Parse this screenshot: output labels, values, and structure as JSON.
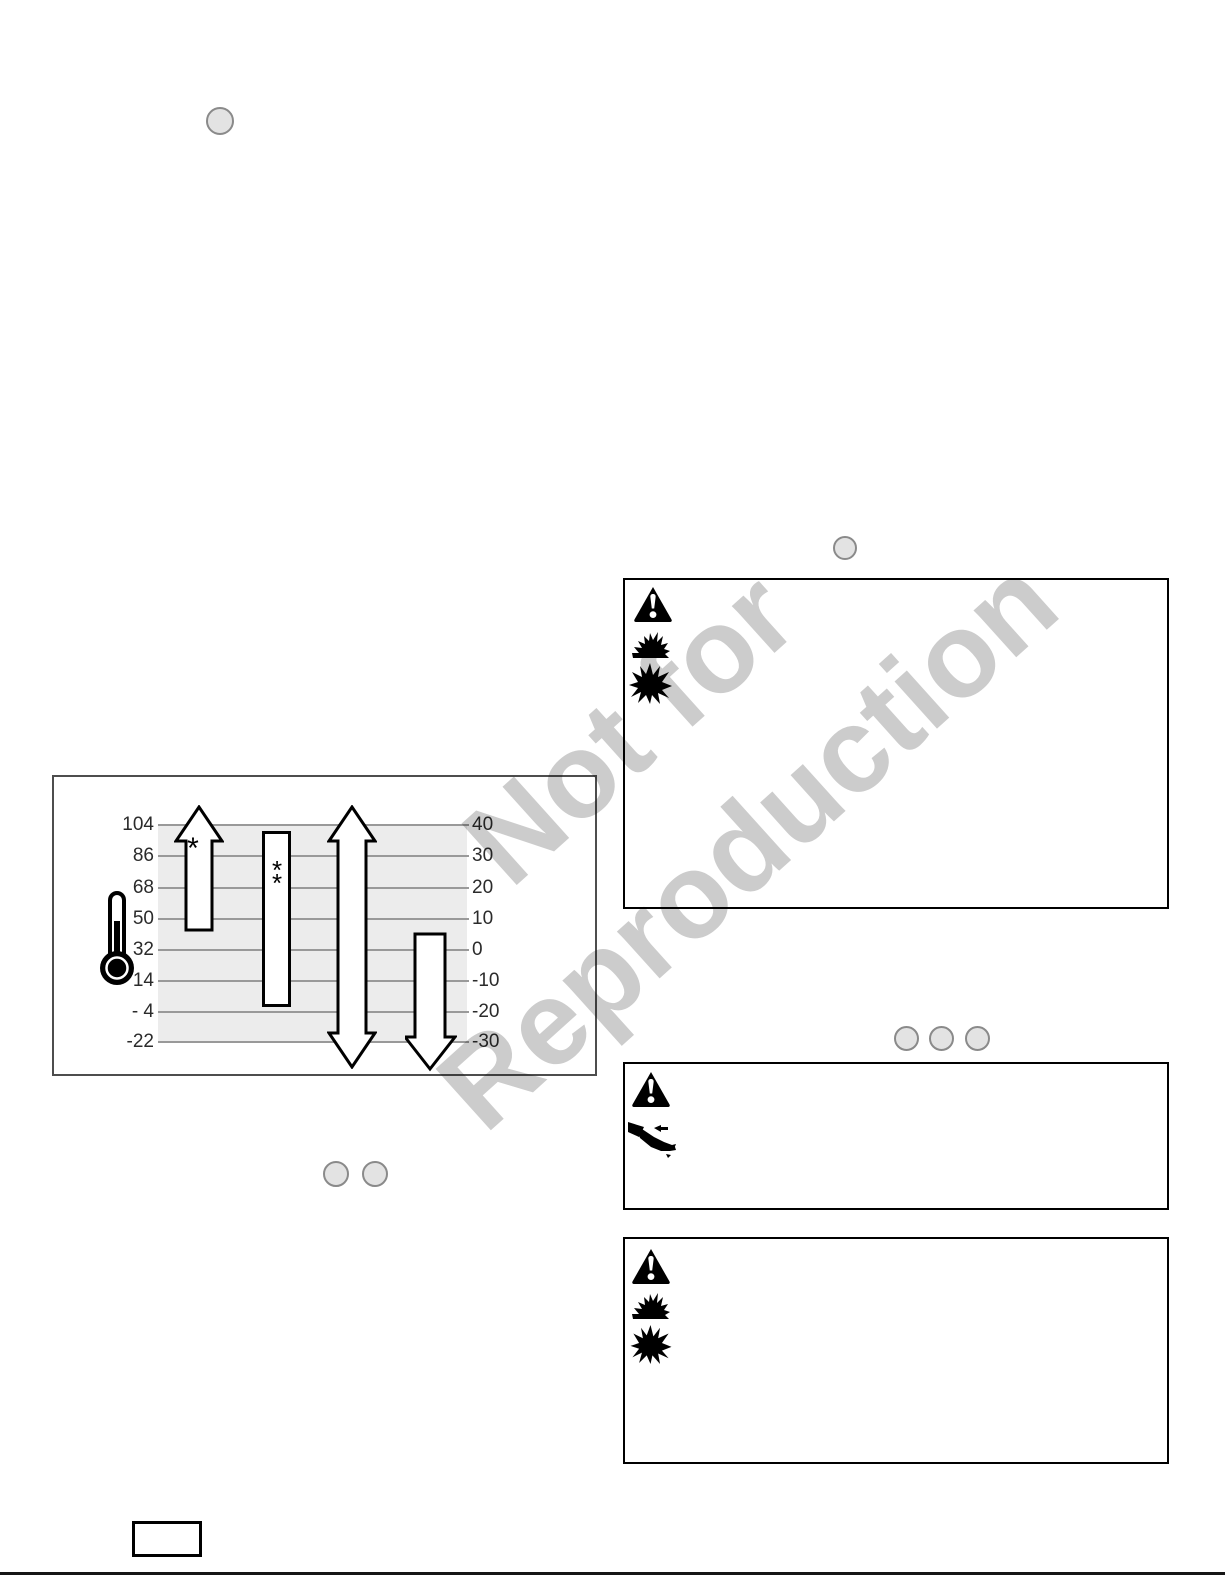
{
  "watermark": {
    "line1": "Not for",
    "line2": "Reproduction"
  },
  "colors": {
    "watermark": "#cccccc",
    "chart_shade": "#ececec",
    "gridline": "#999999",
    "callout_fill": "#e3e3e3",
    "callout_border": "#8a8a8a",
    "box_border": "#000000"
  },
  "chart_data": {
    "type": "bar",
    "title": "",
    "description": "Ambient temperature range diagram with four vertical range indicators beside a thermometer icon",
    "grid": true,
    "fahrenheit_ticks": [
      "104",
      "86",
      "68",
      "50",
      "32",
      "14",
      "- 4",
      "-22"
    ],
    "celsius_ticks": [
      "40",
      "30",
      "20",
      "10",
      "0",
      "-10",
      "-20",
      "-30"
    ],
    "axis_left_range": [
      -22,
      104
    ],
    "axis_right_range": [
      -30,
      40
    ],
    "series": [
      {
        "marker": "*",
        "shape": "up-arrow",
        "range_f": [
          40,
          104
        ],
        "open_above": true
      },
      {
        "marker": "**",
        "shape": "bar",
        "range_f": [
          0,
          100
        ]
      },
      {
        "marker": "",
        "shape": "double-arrow",
        "range_f": [
          -22,
          104
        ],
        "open_above": true,
        "open_below": true
      },
      {
        "marker": "",
        "shape": "down-arrow",
        "range_f": [
          -22,
          40
        ],
        "open_below": true
      }
    ],
    "legend": []
  },
  "chart_icon": "thermometer-icon",
  "warning_boxes": [
    {
      "id": "fuel-fire-explosion-top",
      "text": "",
      "hazard_icons": [
        "warning-triangle-icon",
        "fire-icon",
        "explosion-icon"
      ]
    },
    {
      "id": "fluid-injection",
      "text": "",
      "hazard_icons": [
        "warning-triangle-icon",
        "fluid-injection-icon"
      ]
    },
    {
      "id": "fuel-fire-explosion-bottom",
      "text": "",
      "hazard_icons": [
        "warning-triangle-icon",
        "fire-icon",
        "explosion-icon"
      ]
    }
  ],
  "callout_circles": {
    "labels": [
      "",
      "",
      "",
      "",
      "",
      "",
      ""
    ]
  }
}
